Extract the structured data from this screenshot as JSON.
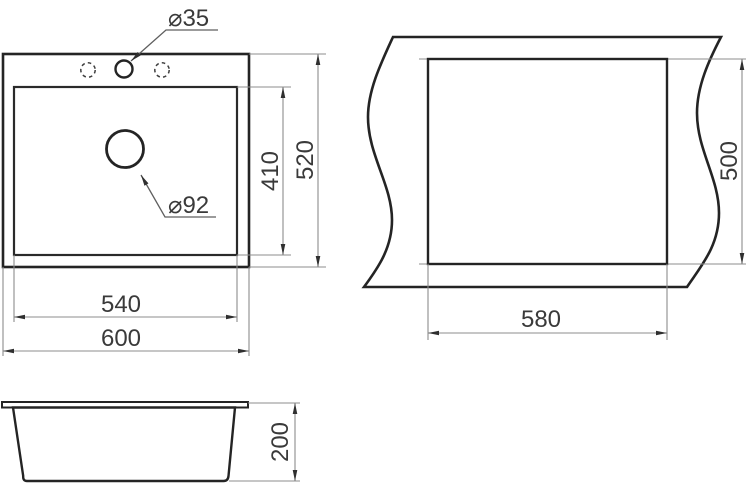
{
  "drawing": {
    "type": "technical-dimension-drawing",
    "subject": "kitchen sink installation dimensions",
    "units": "mm",
    "views": {
      "top": {
        "faucet_hole": "⌀35",
        "drain_hole": "⌀92",
        "inner_width": "540",
        "outer_width": "600",
        "inner_depth": "410",
        "outer_depth": "520"
      },
      "cutout": {
        "width": "580",
        "depth": "500"
      },
      "side": {
        "height": "200"
      }
    },
    "colors": {
      "background": "#ffffff",
      "outline": "#242424",
      "dimension_line": "#8c8c8c",
      "arrow": "#2f2f2f",
      "text": "#3a3a3a"
    }
  }
}
